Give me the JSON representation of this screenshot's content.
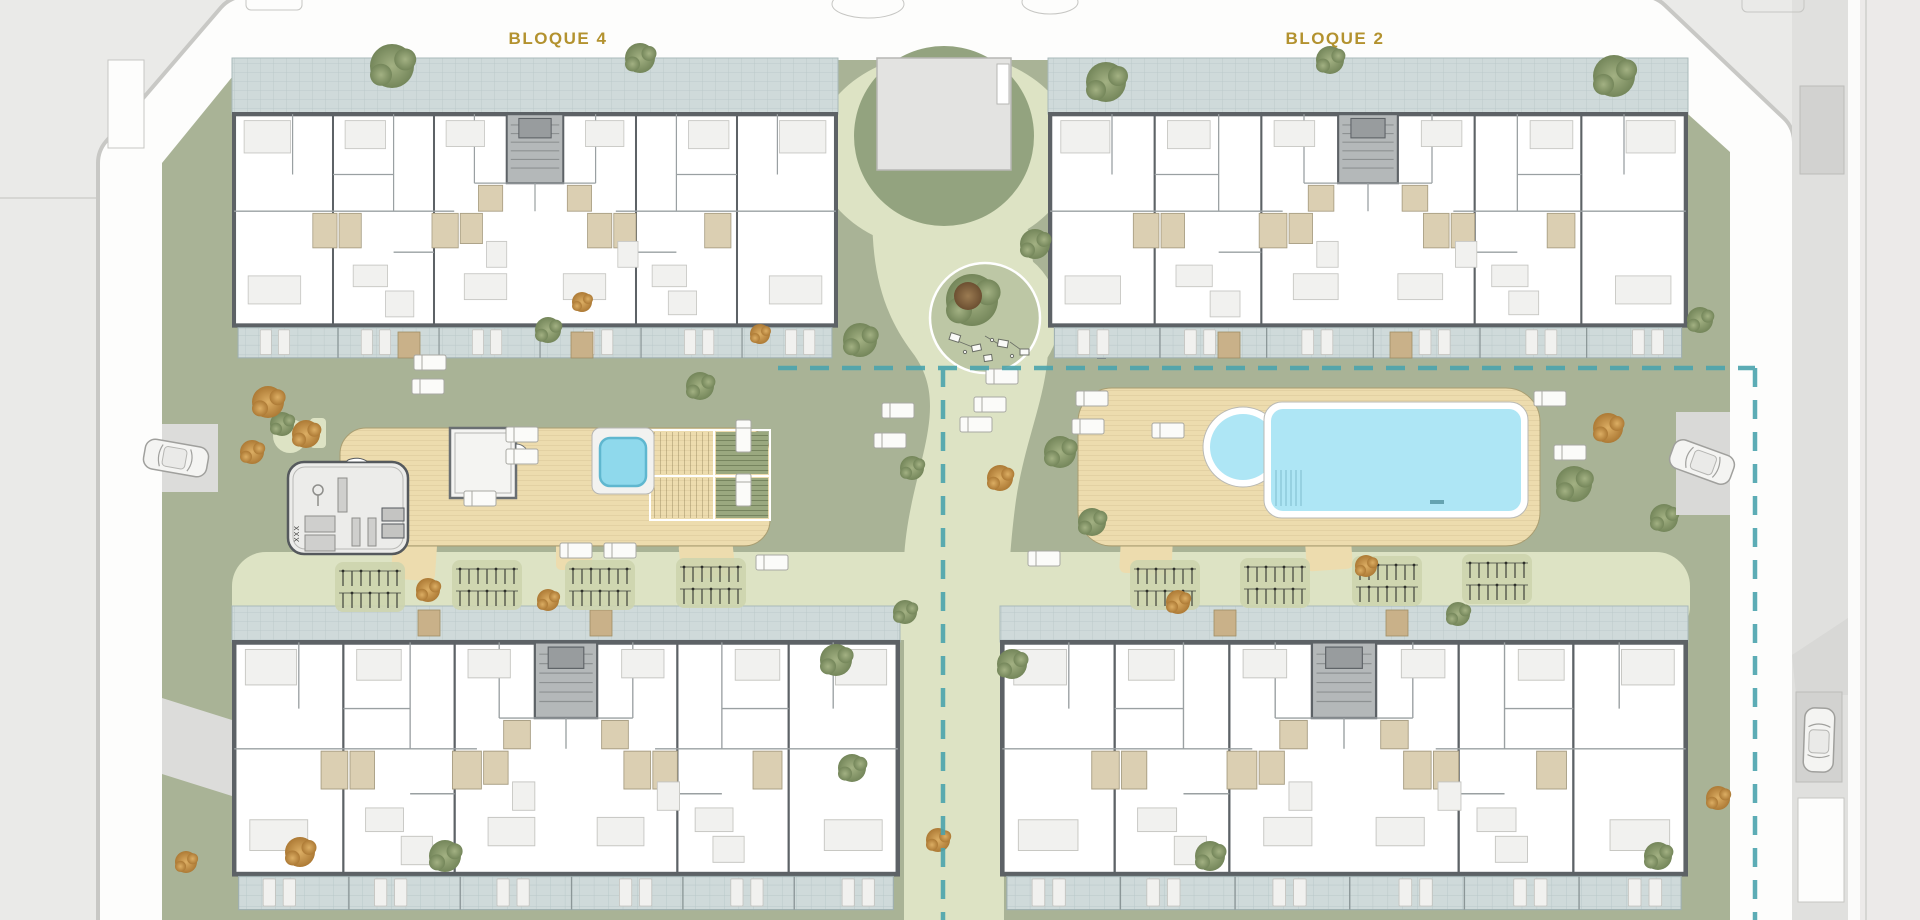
{
  "plan": {
    "labels": {
      "bloque4": "BLOQUE 4",
      "bloque2": "BLOQUE 2"
    },
    "gym_marks": "XXX",
    "colors": {
      "outer": "#eaeae8",
      "road": "#fdfdfc",
      "lawn": "#a9b396",
      "path": "#dde3c4",
      "plaza_lawn": "#93a37f",
      "tile": "#cfdada",
      "deck": "#eddcae",
      "pool_water": "#aee6f5",
      "spa_water": "#8fd9ec",
      "building": "#ffffff",
      "wall": "#5d6266",
      "boundary": "#4aa3ad",
      "label_text": "#b3922f"
    }
  }
}
